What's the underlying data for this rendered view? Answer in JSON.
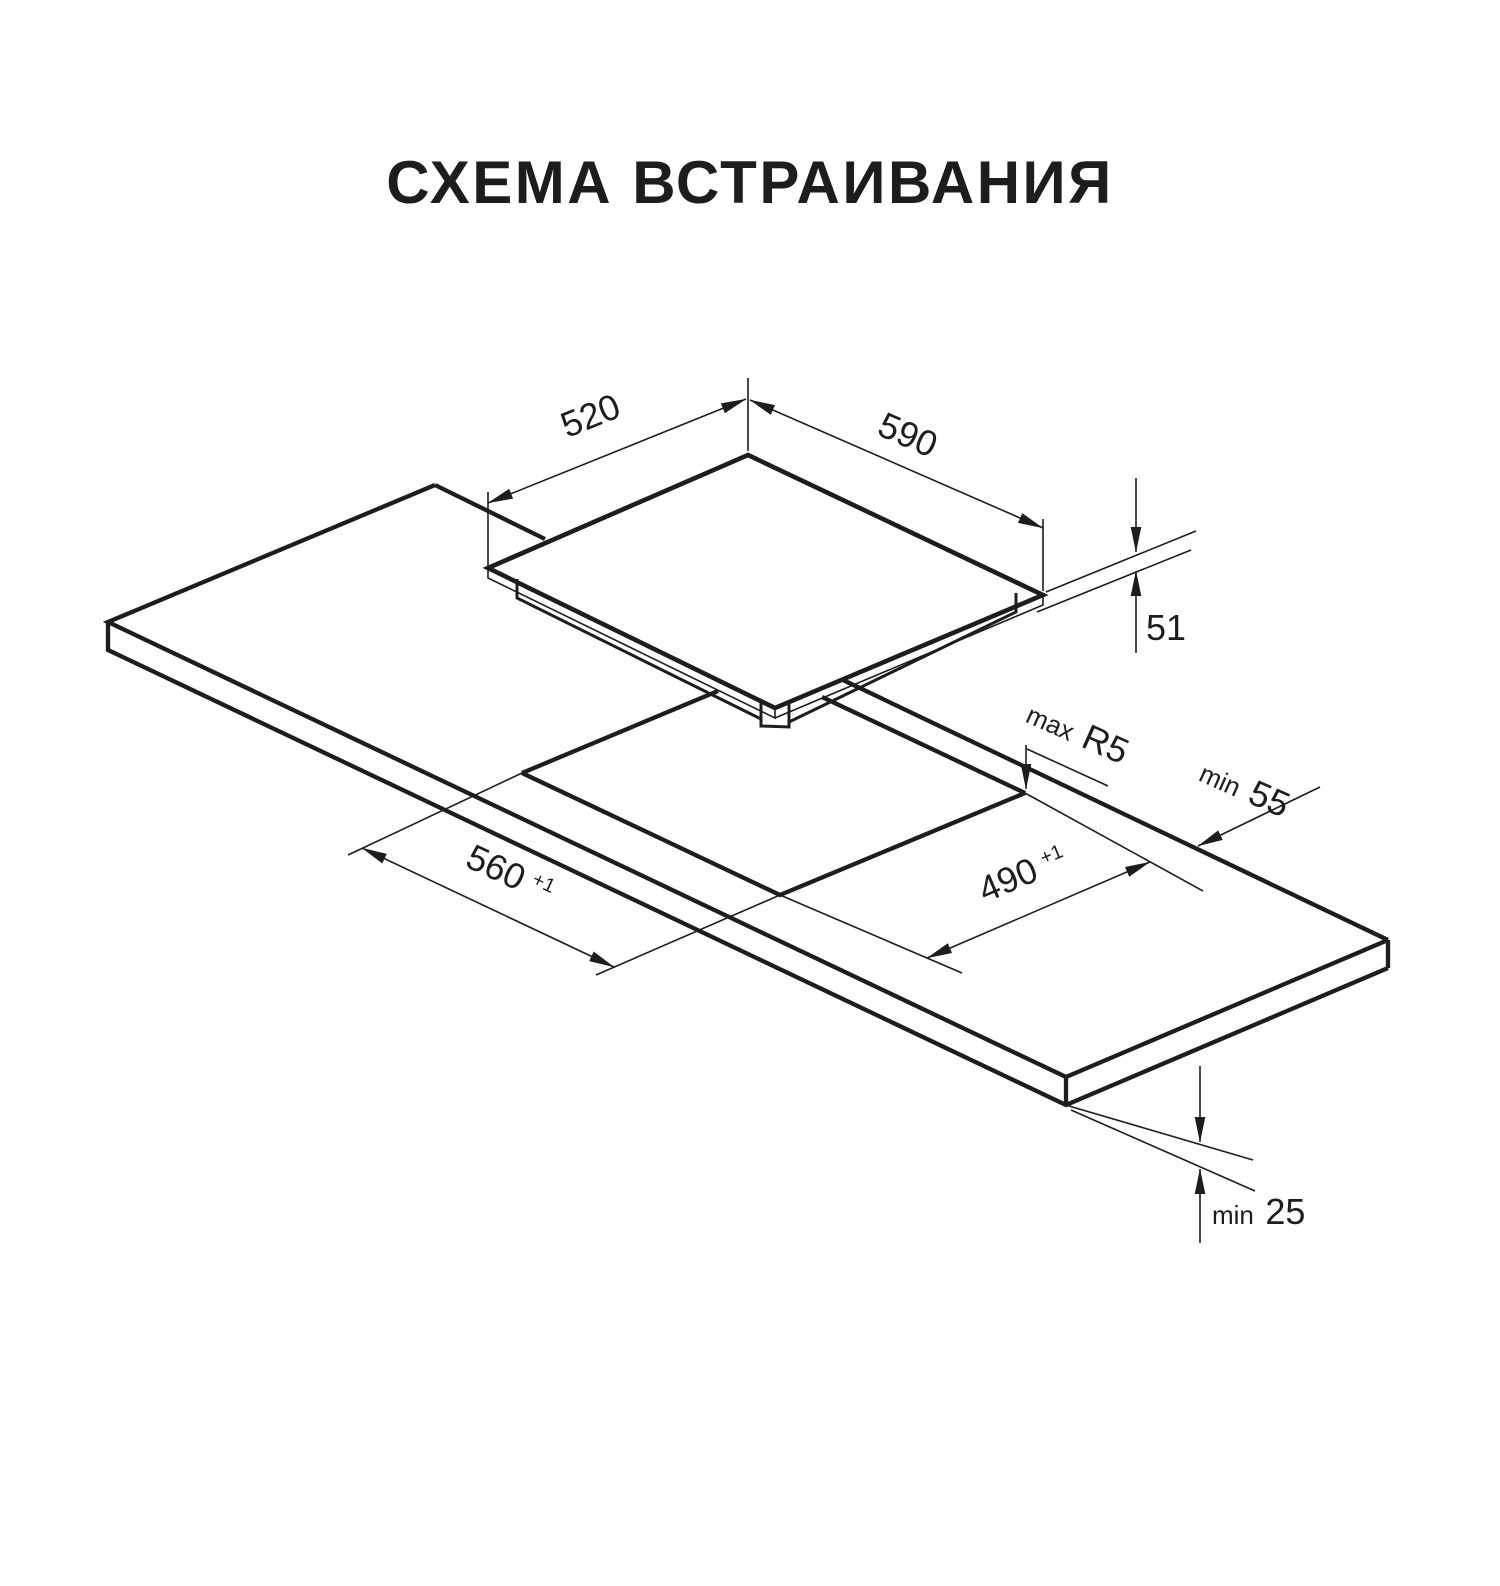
{
  "title": "СХЕМА ВСТРАИВАНИЯ",
  "dimensions": {
    "hob_depth": {
      "value": "520"
    },
    "hob_width": {
      "value": "590"
    },
    "hob_height": {
      "value": "51"
    },
    "cutout_width": {
      "value": "560",
      "tolerance": "+1"
    },
    "cutout_depth": {
      "value": "490",
      "tolerance": "+1"
    },
    "cutout_corner_radius": {
      "prefix": "max",
      "value": "R5"
    },
    "rear_edge_clearance": {
      "prefix": "min",
      "value": "55"
    },
    "bottom_clearance": {
      "prefix": "min",
      "value": "25"
    }
  },
  "colors": {
    "line": "#1d1d1b",
    "background": "#ffffff"
  }
}
